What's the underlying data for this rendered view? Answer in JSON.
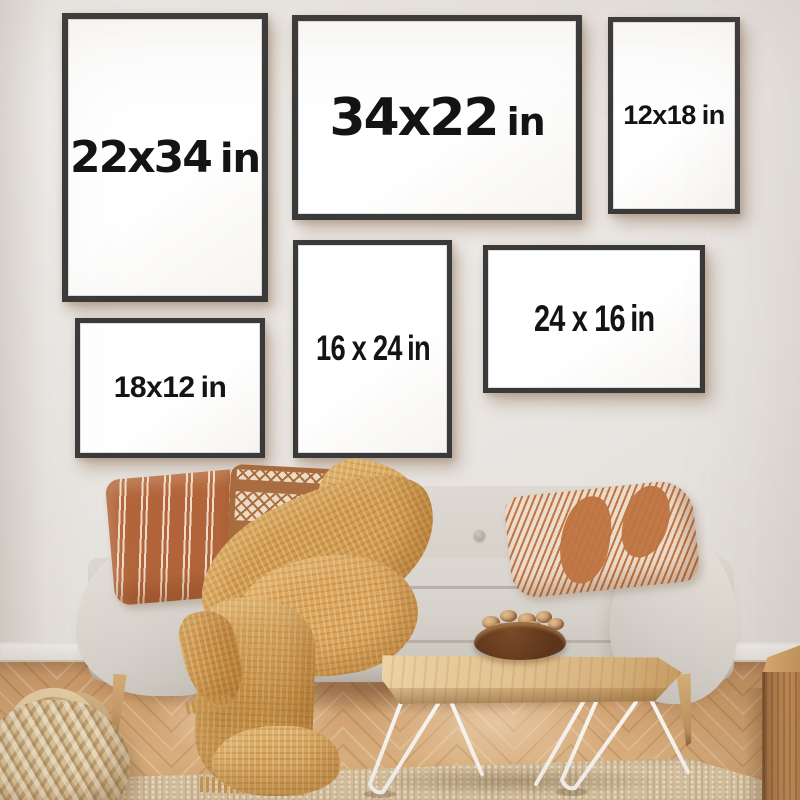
{
  "scene": {
    "objects": [
      "picture-frame",
      "sofa",
      "striped-pillow",
      "diamond-pillow",
      "chevron-pillow",
      "throw-blanket",
      "coffee-table",
      "nut-bowl",
      "wicker-basket",
      "wood-cube-side-table",
      "jute-rug",
      "herringbone-floor",
      "baseboard",
      "wall"
    ]
  },
  "frames": [
    {
      "id": "22x34",
      "size": "22x34",
      "unit": "in",
      "orientation": "portrait"
    },
    {
      "id": "34x22",
      "size": "34x22",
      "unit": "in",
      "orientation": "landscape"
    },
    {
      "id": "12x18",
      "size": "12x18",
      "unit": "in",
      "orientation": "portrait"
    },
    {
      "id": "16x24",
      "size": "16 x 24",
      "unit": "in",
      "orientation": "portrait"
    },
    {
      "id": "24x16",
      "size": "24 x 16",
      "unit": "in",
      "orientation": "landscape"
    },
    {
      "id": "18x12",
      "size": "18x12",
      "unit": "in",
      "orientation": "landscape"
    }
  ],
  "colors": {
    "wall": "#ebe7e4",
    "frame_border": "#3b3a3a",
    "frame_canvas": "#ffffff",
    "label_text": "#141414",
    "sofa": "#d6d2ca",
    "blanket": "#d6a157",
    "pillow_terracotta": "#b2653a",
    "pillow_brown": "#a96d3f",
    "pillow_cream": "#ecdbc4",
    "floor_wood": "#cf9d6b",
    "rug": "#d8c3a1",
    "table_wood": "#e2c28f",
    "table_legs": "#f7f5f1",
    "bowl": "#63391d",
    "basket": "#dcc39c",
    "cube_wood": "#b07a48"
  }
}
